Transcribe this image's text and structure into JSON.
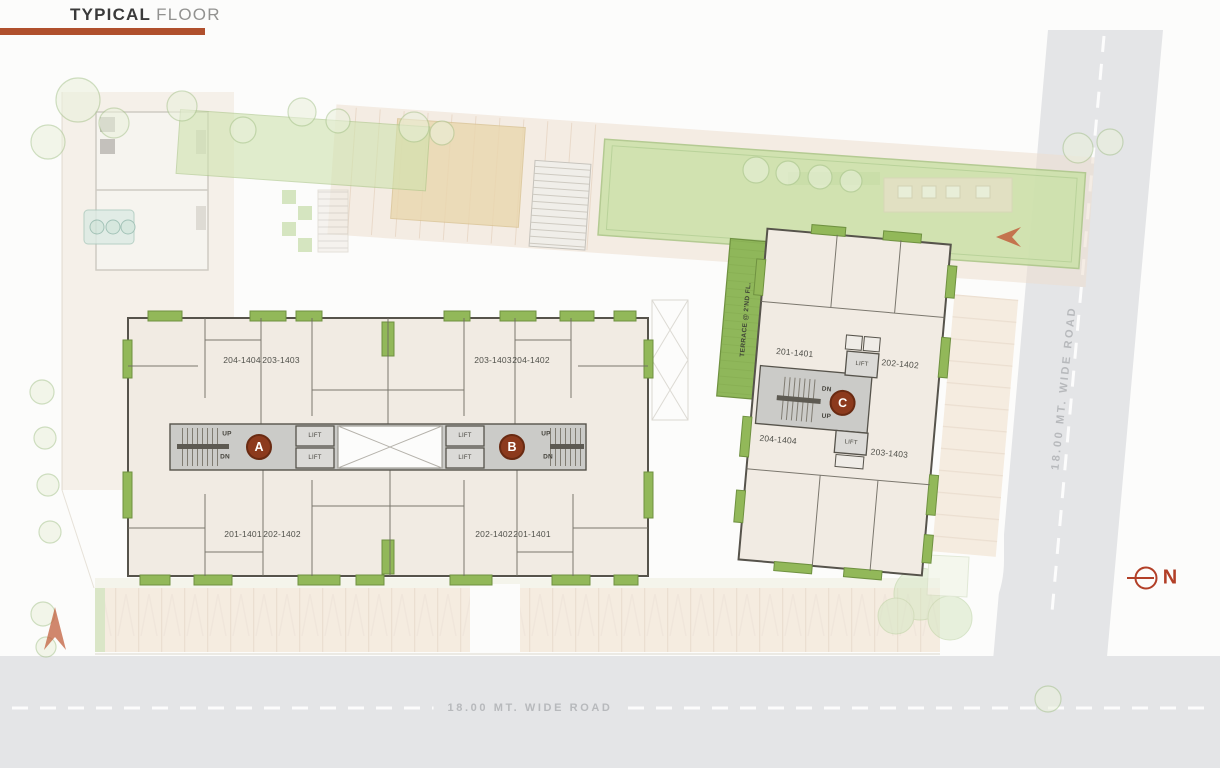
{
  "title": {
    "primary": "TYPICAL",
    "secondary": "FLOOR"
  },
  "roads": {
    "right_label": "18.00 MT. WIDE ROAD",
    "bottom_label": "18.00 MT. WIDE ROAD"
  },
  "north_label": "N",
  "labels": {
    "lift": "LIFT",
    "up": "UP",
    "down": "DN",
    "terrace": "TERRACE @ 2'ND FL."
  },
  "colors": {
    "accent_bar": "#b0502d",
    "badge": "#8c3a1d",
    "balcony_green": "#92b859",
    "building_cream": "#f1ebe3",
    "core_gray": "#cbcbc8",
    "road_gray": "#e4e5e7",
    "road_text": "#b7b9bc"
  },
  "blocks": {
    "a": {
      "badge": "A",
      "units_top": [
        "204-1404",
        "203-1403"
      ],
      "units_bottom": [
        "201-1401",
        "202-1402"
      ]
    },
    "b": {
      "badge": "B",
      "units_top": [
        "203-1403",
        "204-1402"
      ],
      "units_bottom": [
        "202-1402",
        "201-1401"
      ]
    },
    "c": {
      "badge": "C",
      "units": {
        "top_left": "201-1401",
        "top_right": "202-1402",
        "bottom_left": "204-1404",
        "bottom_right": "203-1403"
      }
    }
  }
}
